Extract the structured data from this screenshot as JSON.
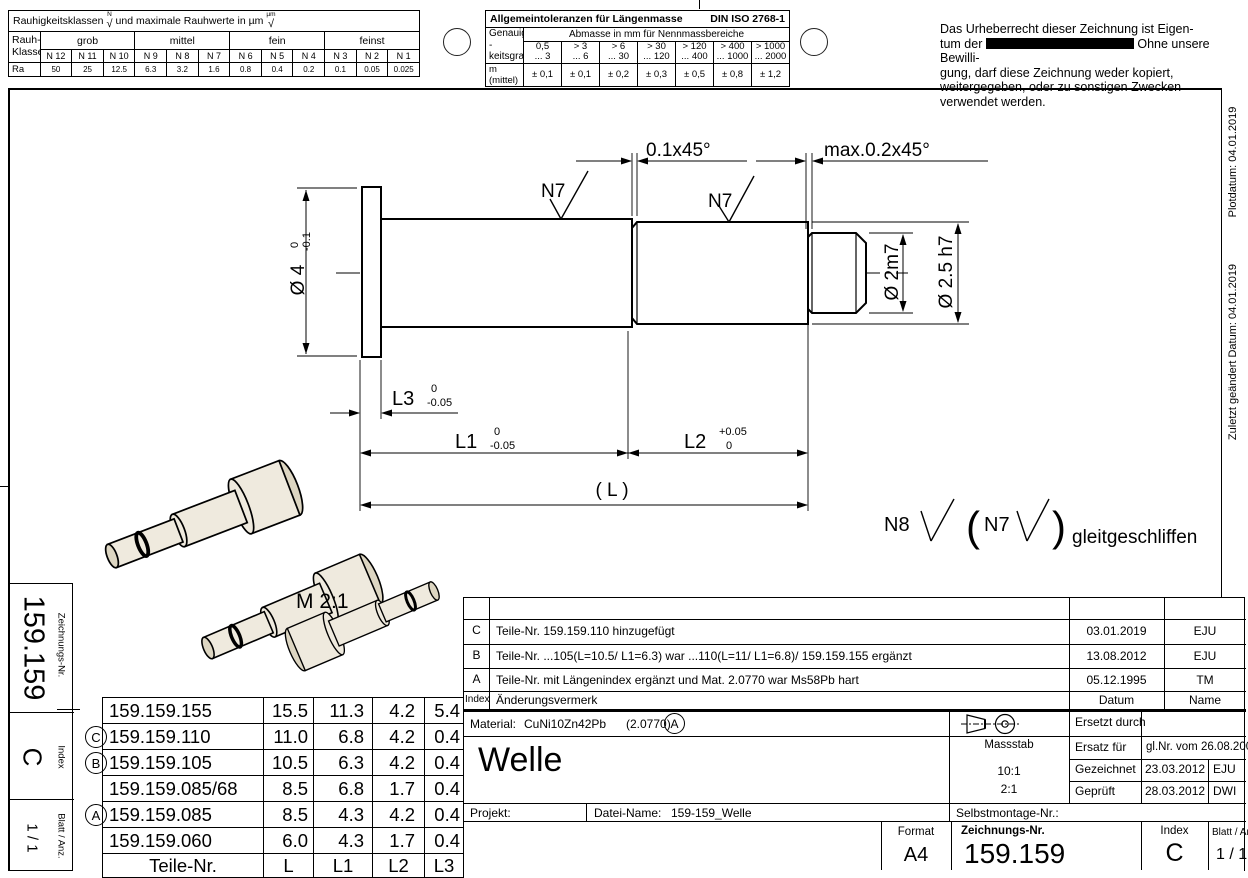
{
  "roughness_table": {
    "title_a": "Rauhigkeitsklassen",
    "title_sym_a": "N",
    "title_b": "und maximale Rauhwerte in µm",
    "title_sym_b": "µm",
    "row_label": "Rauh-\nKlasse",
    "groups": [
      "grob",
      "mittel",
      "fein",
      "feinst"
    ],
    "classes": [
      "N 12",
      "N 11",
      "N 10",
      "N 9",
      "N 8",
      "N 7",
      "N 6",
      "N 5",
      "N 4",
      "N 3",
      "N 2",
      "N 1"
    ],
    "ra_label": "Ra",
    "ra": [
      "50",
      "25",
      "12.5",
      "6.3",
      "3.2",
      "1.6",
      "0.8",
      "0.4",
      "0.2",
      "0.1",
      "0.05",
      "0.025"
    ]
  },
  "tolerance_table": {
    "title": "Allgemeintoleranzen für Längenmasse",
    "standard": "DIN ISO 2768-1",
    "row_header": "Genauig -\nkeitsgrad",
    "col_header": "Abmasse in mm für Nennmassbereiche",
    "ranges": [
      {
        "a": "0,5",
        "b": "... 3"
      },
      {
        "a": "> 3",
        "b": "... 6"
      },
      {
        "a": "> 6",
        "b": "... 30"
      },
      {
        "a": "> 30",
        "b": "... 120"
      },
      {
        "a": "> 120",
        "b": "... 400"
      },
      {
        "a": "> 400",
        "b": "... 1000"
      },
      {
        "a": "> 1000",
        "b": "... 2000"
      }
    ],
    "m_label": "m (mittel)",
    "m_values": [
      "± 0,1",
      "± 0,1",
      "± 0,2",
      "± 0,3",
      "± 0,5",
      "± 0,8",
      "± 1,2"
    ]
  },
  "copyright": {
    "line1": "Das Urheberrecht dieser Zeichnung ist Eigen-",
    "line2_pre": "tum der",
    "line2_post": "Ohne unsere Bewilli-",
    "line3": "gung, darf diese Zeichnung weder kopiert,",
    "line4": "weitergegeben, oder zu sonstigen Zwecken",
    "line5": "verwendet werden."
  },
  "margin_notes": {
    "plot_date": "Plotdatum: 04.01.2019",
    "modified": "Zuletzt geändert Datum: 04.01.2019"
  },
  "drawing": {
    "scale_label": "M 2:1",
    "dia_flange": "Ø 4",
    "dia_flange_tol_hi": "0",
    "dia_flange_tol_lo": "-0.1",
    "chamfer_left": "0.1x45°",
    "chamfer_right": "max.0.2x45°",
    "dia_end": "Ø 2m7",
    "dia_mid": "Ø 2.5 h7",
    "len1": "L1",
    "len1_hi": "0",
    "len1_lo": "-0.05",
    "len2": "L2",
    "len2_hi": "+0.05",
    "len2_lo": "0",
    "len3": "L3",
    "len3_hi": "0",
    "len3_lo": "-0.05",
    "len_total": "( L )",
    "surface1": "N7",
    "surface2": "N7",
    "note_rough": "N8",
    "note_fine": "N7",
    "paren_open": "(",
    "paren_close": ")",
    "note_text": "gleitgeschliffen"
  },
  "parts_table": {
    "headers": {
      "nr": "Teile-Nr.",
      "l": "L",
      "l1": "L1",
      "l2": "L2",
      "l3": "L3"
    },
    "rows": [
      {
        "marker": "",
        "nr": "159.159.155",
        "l": "15.5",
        "l1": "11.3",
        "l2": "4.2",
        "l3": "5.4"
      },
      {
        "marker": "C",
        "nr": "159.159.110",
        "l": "11.0",
        "l1": "6.8",
        "l2": "4.2",
        "l3": "0.4"
      },
      {
        "marker": "B",
        "nr": "159.159.105",
        "l": "10.5",
        "l1": "6.3",
        "l2": "4.2",
        "l3": "0.4"
      },
      {
        "marker": "",
        "nr": "159.159.085/68",
        "l": "8.5",
        "l1": "6.8",
        "l2": "1.7",
        "l3": "0.4"
      },
      {
        "marker": "A",
        "nr": "159.159.085",
        "l": "8.5",
        "l1": "4.3",
        "l2": "4.2",
        "l3": "0.4"
      },
      {
        "marker": "",
        "nr": "159.159.060",
        "l": "6.0",
        "l1": "4.3",
        "l2": "1.7",
        "l3": "0.4"
      }
    ]
  },
  "revision_table": {
    "header": {
      "index": "Index",
      "text": "Änderungsvermerk",
      "date": "Datum",
      "name": "Name"
    },
    "rows": [
      {
        "index": "C",
        "text": "Teile-Nr. 159.159.110 hinzugefügt",
        "date": "03.01.2019",
        "name": "EJU"
      },
      {
        "index": "B",
        "text": "Teile-Nr. ...105(L=10.5/ L1=6.3) war ...110(L=11/ L1=6.8)/ 159.159.155 ergänzt",
        "date": "13.08.2012",
        "name": "EJU"
      },
      {
        "index": "A",
        "text": "Teile-Nr. mit Längenindex ergänzt und Mat. 2.0770 war Ms58Pb hart",
        "date": "05.12.1995",
        "name": "TM"
      }
    ]
  },
  "title_block": {
    "material_label": "Material:",
    "material_value": "CuNi10Zn42Pb",
    "material_nr": "(2.0770)",
    "material_rev": "A",
    "title": "Welle",
    "massstab_label": "Massstab",
    "scale1": "10:1",
    "scale2": "2:1",
    "ersetzt_label": "Ersetzt durch",
    "ersatz_label": "Ersatz für",
    "ersatz_value": "gl.Nr. vom 26.08.2002",
    "gezeichnet_label": "Gezeichnet",
    "gezeichnet_date": "23.03.2012",
    "gezeichnet_name": "EJU",
    "geprueft_label": "Geprüft",
    "geprueft_date": "28.03.2012",
    "geprueft_name": "DWI",
    "projekt_label": "Projekt:",
    "datei_label": "Datei-Name:",
    "datei_value": "159-159_Welle",
    "selbstmontage_label": "Selbstmontage-Nr.:",
    "format_label": "Format",
    "format_value": "A4",
    "zeichnung_label": "Zeichnungs-Nr.",
    "zeichnung_value": "159.159",
    "index_label": "Index",
    "index_value": "C",
    "blatt_label": "Blatt / Anz.",
    "blatt_value": "1 / 1"
  },
  "side_strip": {
    "zeichnung_label": "Zeichnungs-Nr.",
    "zeichnung_value": "159.159",
    "index_label": "Index",
    "index_value": "C",
    "blatt_label": "Blatt / Anz.",
    "blatt_value": "1 / 1"
  }
}
